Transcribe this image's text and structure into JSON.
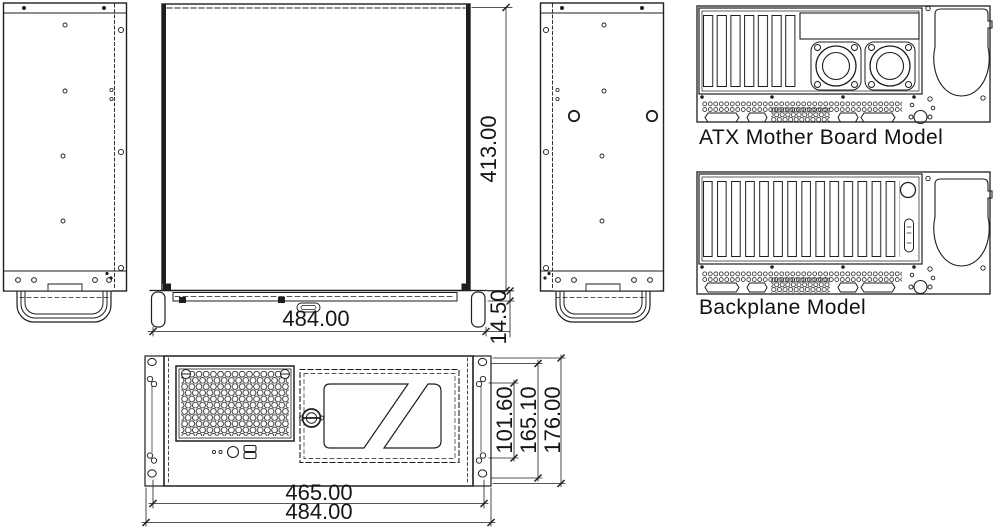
{
  "canvas": {
    "background": "#ffffff",
    "ink": "#1e1e1e"
  },
  "labels": {
    "atx_model": "ATX Mother Board Model",
    "backplane_model": "Backplane Model"
  },
  "dims": {
    "depth": "413.00",
    "top_width": "484.00",
    "front_strip": "14.50",
    "body_width": "465.00",
    "overall_width": "484.00",
    "opening_height": "101.60",
    "mount_height": "165.10",
    "overall_height": "176.00"
  }
}
